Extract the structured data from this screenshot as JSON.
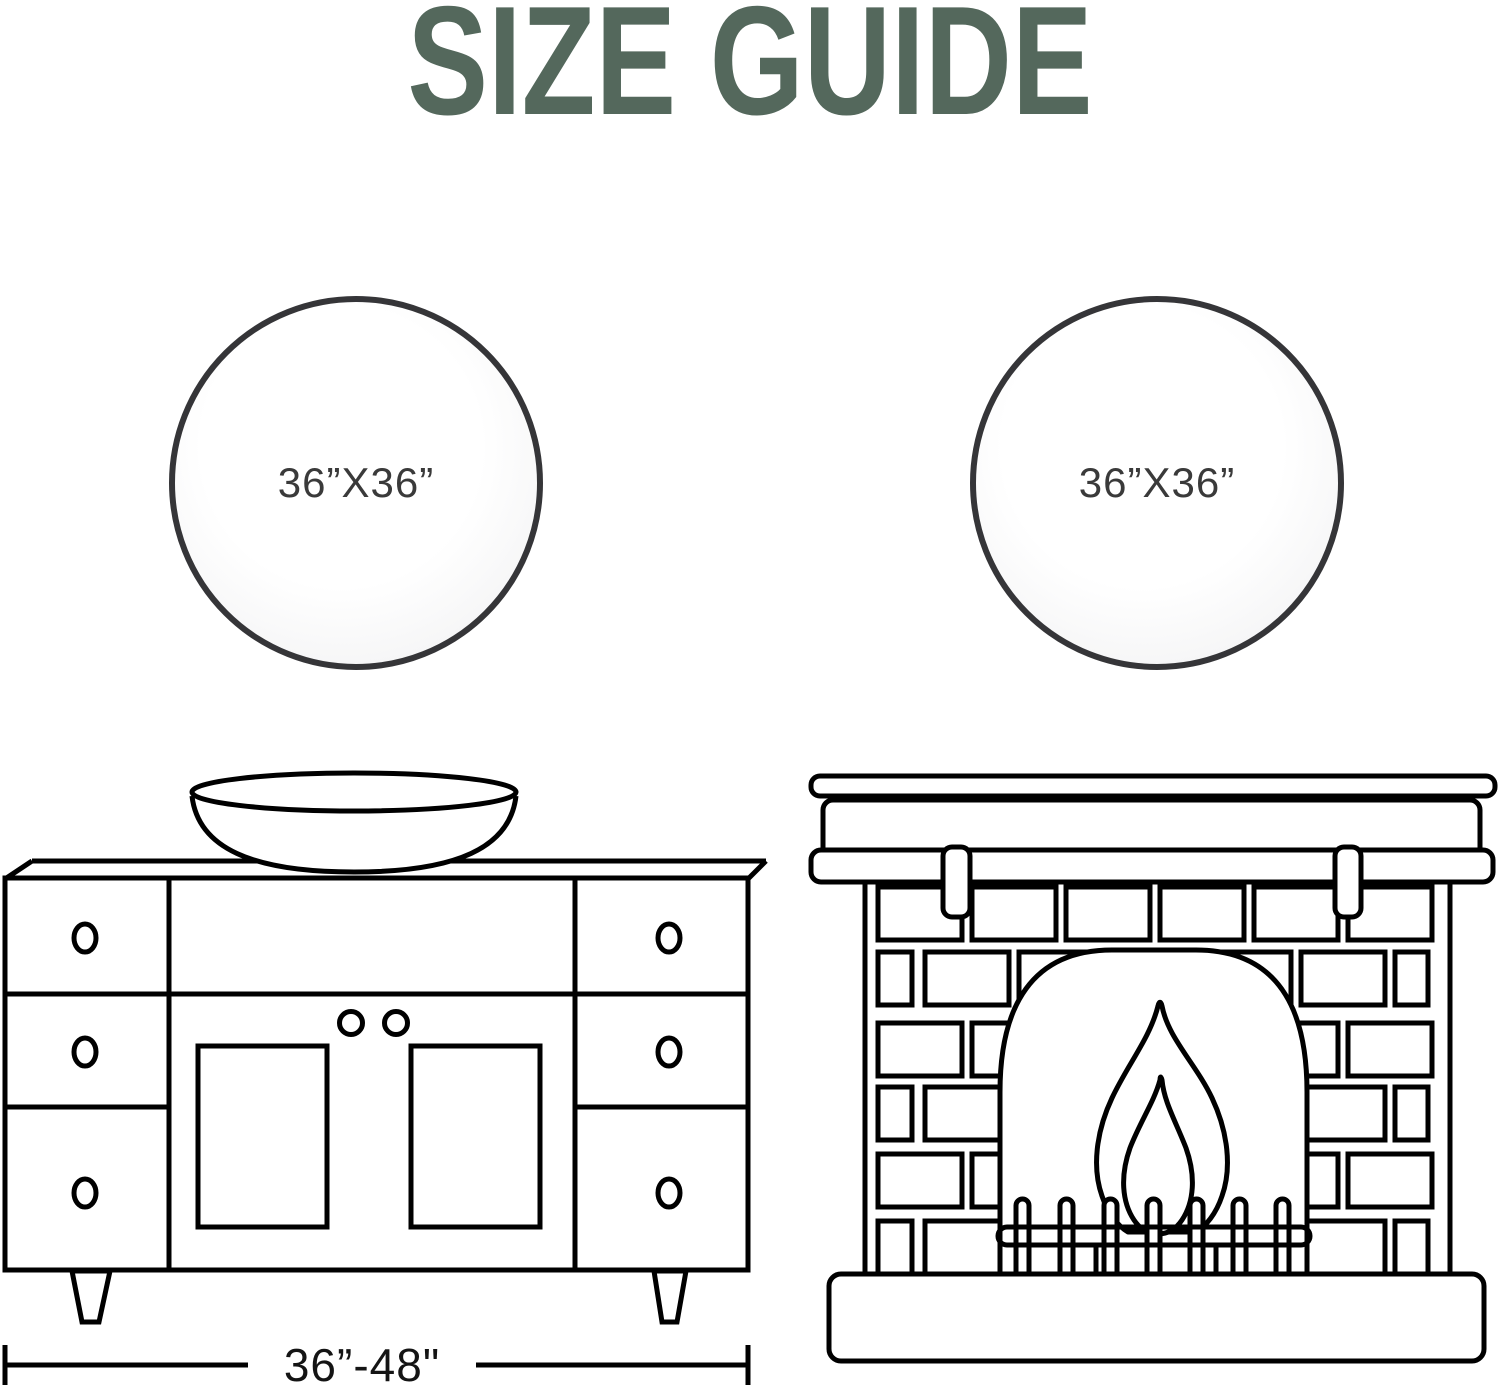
{
  "title": {
    "text": "SIZE GUIDE",
    "color": "#54685c"
  },
  "mirrors": {
    "left": {
      "label": "36”X36”"
    },
    "right": {
      "label": "36”X36”"
    }
  },
  "vanity": {
    "width_range_label": "36”-48\""
  },
  "colors": {
    "line_art": "#000000",
    "mirror_frame": "#353538",
    "mirror_glass": "#f4f4f5",
    "label_text": "#3a3a3a"
  }
}
